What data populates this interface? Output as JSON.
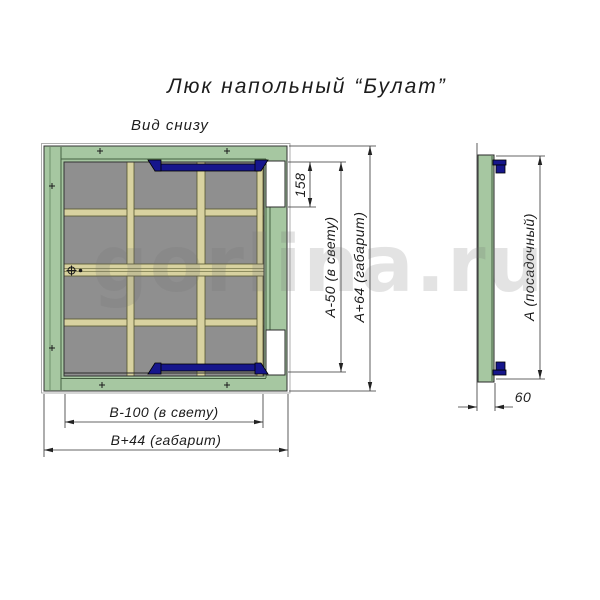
{
  "title": "Люк напольный “Булат”",
  "view_label": "Вид снизу",
  "watermark": "gorlina.ru",
  "dimensions": {
    "hinge_offset": "158",
    "height_clear": "А-50 (в свету)",
    "height_overall": "А+64 (габарит)",
    "width_clear": "В-100 (в свету)",
    "width_overall": "В+44 (габарит)",
    "height_seating": "А (посадочный)",
    "profile_depth": "60"
  },
  "colors": {
    "frame-green": "#a6c7a1",
    "panel-gray": "#8f8f8f",
    "stiffener-beige": "#d8d2a0",
    "hinge-navy": "#16168c",
    "watermark-gray": "rgba(115,115,115,0.20)"
  }
}
